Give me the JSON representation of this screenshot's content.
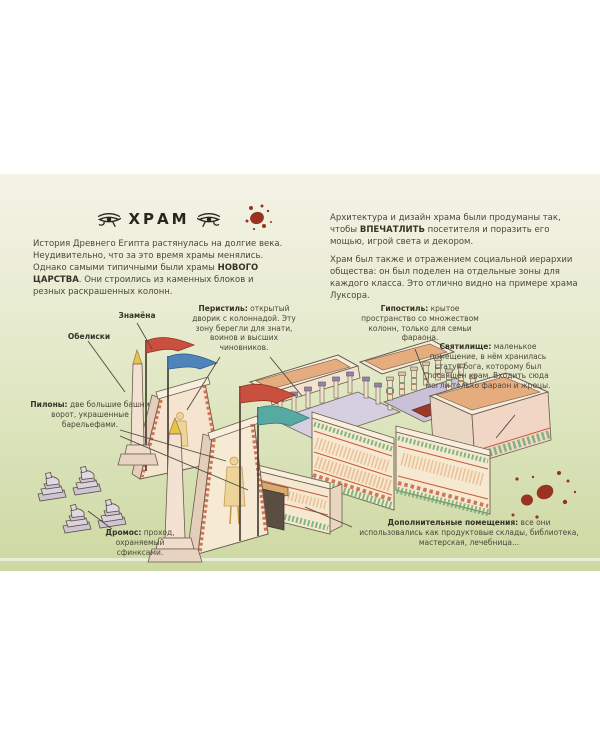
{
  "header": {
    "title": "ХРАМ",
    "left_icon": "eye-of-horus",
    "right_icon": "eye-of-horus"
  },
  "intro": {
    "left": {
      "pre": "История Древнего Египта растянулась на долгие века. Неудивительно, что за это время храмы менялись. Однако самыми типичными были храмы ",
      "bold": "НОВОГО ЦАРСТВА",
      "post": ". Они строились из каменных блоков и резных раскрашенных колонн."
    },
    "right_first": {
      "pre": "Архитектура и дизайн храма были продуманы так, чтобы ",
      "bold": "ВПЕЧАТЛИТЬ",
      "post": " посетителя и поразить его мощью, игрой света и декором."
    },
    "right_second": "Храм был также и отражением социальной иерархии общества: он был поделен на отдельные зоны для каждого класса. Это отлично видно на примере храма Луксора."
  },
  "callouts": {
    "banners": {
      "term": "Знамёна",
      "desc": ""
    },
    "obelisks": {
      "term": "Обелиски",
      "desc": ""
    },
    "peristyle": {
      "term": "Перистиль:",
      "desc": "открытый дворик с колоннадой. Эту зону берегли для знати, воинов и высших чиновников."
    },
    "hypostyle": {
      "term": "Гипостиль:",
      "desc": "крытое пространство со множеством колонн, только для семьи фараона."
    },
    "sanctuary": {
      "term": "Святилище:",
      "desc": "маленькое помещение, в нём хранилась статуя бога, которому был посвящён храм. Входить сюда могли только фараон и жрецы."
    },
    "pylons": {
      "term": "Пилоны:",
      "desc": "две большие башни ворот, украшенные барельефами."
    },
    "dromos": {
      "term": "Дромос:",
      "desc": "проход, охраняемый сфинксами."
    },
    "extra_rooms": {
      "term": "Дополнительные помещения:",
      "desc": "все они использовались как продуктовые склады, библиотека, мастерская, лечебница..."
    }
  },
  "colors": {
    "page_green": "#cdd9a2",
    "ink": "#4d463c",
    "title_ink": "#29261f",
    "splatter_red": "#993221",
    "roof_tan": "#e5ad7e",
    "wall_cream": "#f6e9d2",
    "flag_red": "#c9503f",
    "flag_blue": "#4e84ba",
    "flag_teal": "#56aaa2",
    "obelisk_gold": "#e9c24a",
    "trim_green": "#6fae72",
    "trim_red": "#c75b38",
    "sphinx_grey": "#d8cfda"
  }
}
